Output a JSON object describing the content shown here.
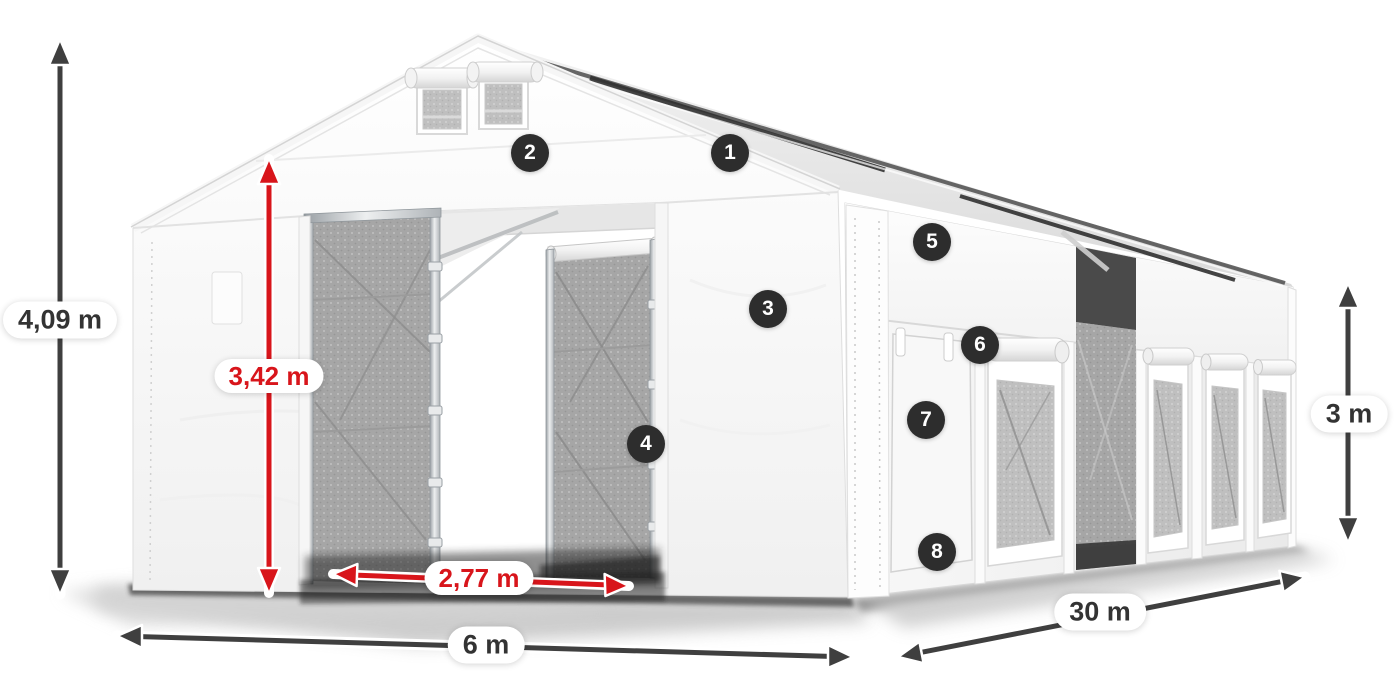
{
  "meta": {
    "description": "Product illustration of a white 6 m x 30 m storage marquee tent with dimension arrows and numbered feature callouts",
    "background": "#ffffff"
  },
  "colors": {
    "arrow_dark": "#3f3f3f",
    "arrow_red": "#d8151b",
    "pill_bg": "#ffffff",
    "pill_text_dark": "#333333",
    "pill_text_red": "#d8151b",
    "badge_bg": "#2d2d2d",
    "badge_text": "#ffffff",
    "tent_white": "#f7f7f7",
    "mesh_gray": "#a6a6a6"
  },
  "dimensions": {
    "total_height": "4,09 m",
    "entrance_height": "3,42 m",
    "entrance_width": "2,77 m",
    "width": "6 m",
    "length": "30 m",
    "side_height": "3 m"
  },
  "callouts": [
    {
      "number": "1"
    },
    {
      "number": "2"
    },
    {
      "number": "3"
    },
    {
      "number": "4"
    },
    {
      "number": "5"
    },
    {
      "number": "6"
    },
    {
      "number": "7"
    },
    {
      "number": "8"
    }
  ]
}
